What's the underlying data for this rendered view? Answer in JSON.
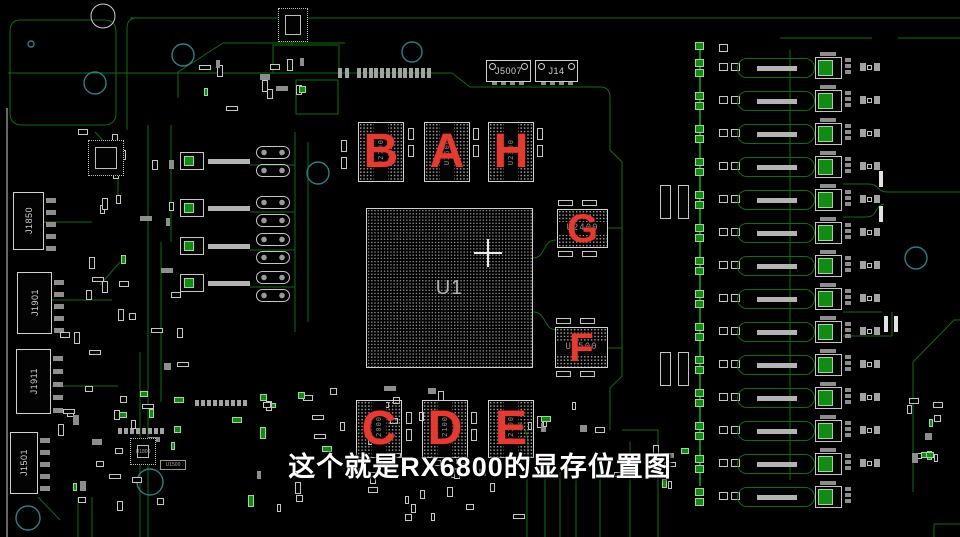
{
  "subtitle": {
    "text": "这个就是RX6800的显存位置图"
  },
  "board": {
    "gpu": {
      "designator": "U1"
    },
    "memory_chips": [
      {
        "letter": "B",
        "designator": "U2700"
      },
      {
        "letter": "A",
        "designator": "U2600"
      },
      {
        "letter": "H",
        "designator": "U2300"
      },
      {
        "letter": "G",
        "designator": "U2400"
      },
      {
        "letter": "F",
        "designator": "U2500"
      },
      {
        "letter": "C",
        "designator": "U2000"
      },
      {
        "letter": "D",
        "designator": "U2100"
      },
      {
        "letter": "E",
        "designator": "U2200"
      }
    ],
    "connectors": [
      {
        "designator": "J1850"
      },
      {
        "designator": "J1901"
      },
      {
        "designator": "J1911"
      },
      {
        "designator": "J5007"
      },
      {
        "designator": "J14"
      },
      {
        "designator": "J1501"
      }
    ],
    "ics": [
      {
        "designator": "U1800"
      },
      {
        "designator": "U1500"
      }
    ]
  },
  "colors": {
    "red": "#e23b31",
    "trace": "#0c6e0c",
    "trace-bright": "#12a312",
    "pad-green": "#138a13",
    "teal": "#2a7f8a",
    "silk": "#cfcfcf"
  }
}
